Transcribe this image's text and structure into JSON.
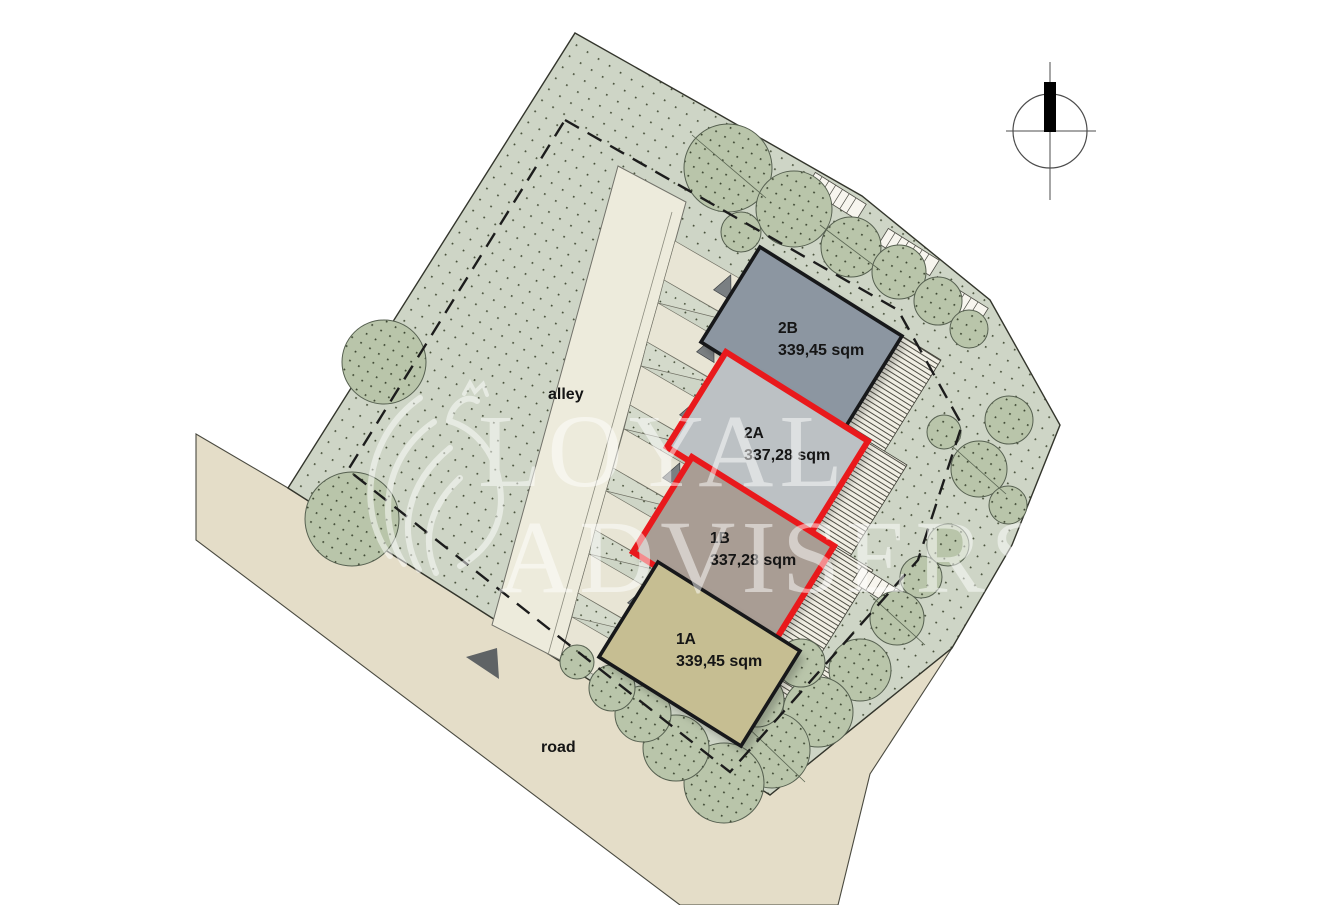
{
  "watermark": {
    "line1": "LOYAL",
    "line2": "ADVISERS"
  },
  "site": {
    "alley_label": "alley",
    "road_label": "road"
  },
  "buildings": [
    {
      "id": "2B",
      "area": "339,45 sqm",
      "fill": "#8c96a1",
      "outline": "#17181a"
    },
    {
      "id": "2A",
      "area": "337,28 sqm",
      "fill": "#bcc1c4",
      "outline": "#e9191c"
    },
    {
      "id": "1B",
      "area": "337,28 sqm",
      "fill": "#a99d94",
      "outline": "#e9191c"
    },
    {
      "id": "1A",
      "area": "339,45 sqm",
      "fill": "#c6be92",
      "outline": "#17181a"
    }
  ],
  "colors": {
    "grass": "#ced5c6",
    "tree": "#b9c5aa",
    "road": "#e4ddc8",
    "alley": "#edebdc",
    "driveway": "#e8e5d5",
    "red_outline": "#e9191c"
  }
}
